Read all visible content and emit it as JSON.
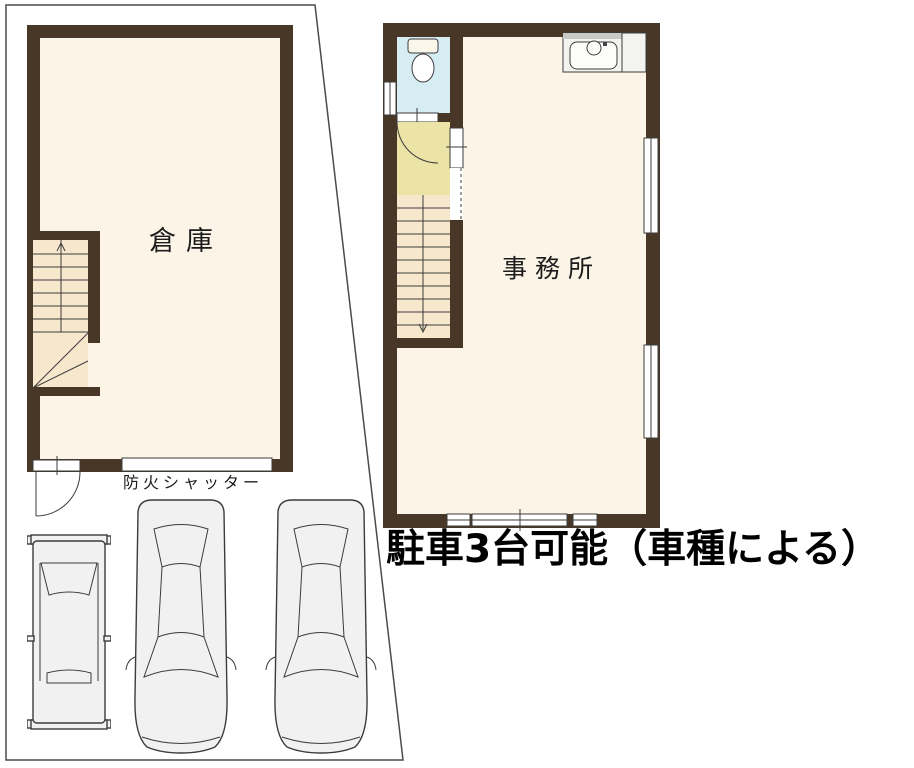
{
  "page": {
    "background": "#ffffff"
  },
  "colors": {
    "page": "#ffffff",
    "wall": "#483726",
    "floor": "#fcf4e6",
    "stair": "#f7e7cd",
    "landing": "#ece4a6",
    "toilet": "#d7edf4",
    "car-fill": "#f1f1f1",
    "line": "#3c3c3c",
    "boundary": "#4b4b4b",
    "text": "#1c1c1c"
  },
  "plan": {
    "warehouse": {
      "label": "倉庫"
    },
    "office": {
      "label": "事務所"
    },
    "fire_shutter": {
      "label": "防火シャッター"
    },
    "parking_note": {
      "label": "駐車3台可能（車種による）"
    }
  },
  "fixtures": {
    "toilet_icon": "toilet-top-view",
    "kitchen_sink_icon": "kitchen-sink-top-view",
    "stairs_up_icon": "stairs-up-arrow",
    "stairs_down_icon": "stairs-down-arrow",
    "entry_door_icon": "swing-door-arc",
    "landing_door_icon": "swing-door-arc",
    "cars": [
      "kei-van-top-view",
      "sedan-top-view",
      "sedan-top-view"
    ]
  }
}
